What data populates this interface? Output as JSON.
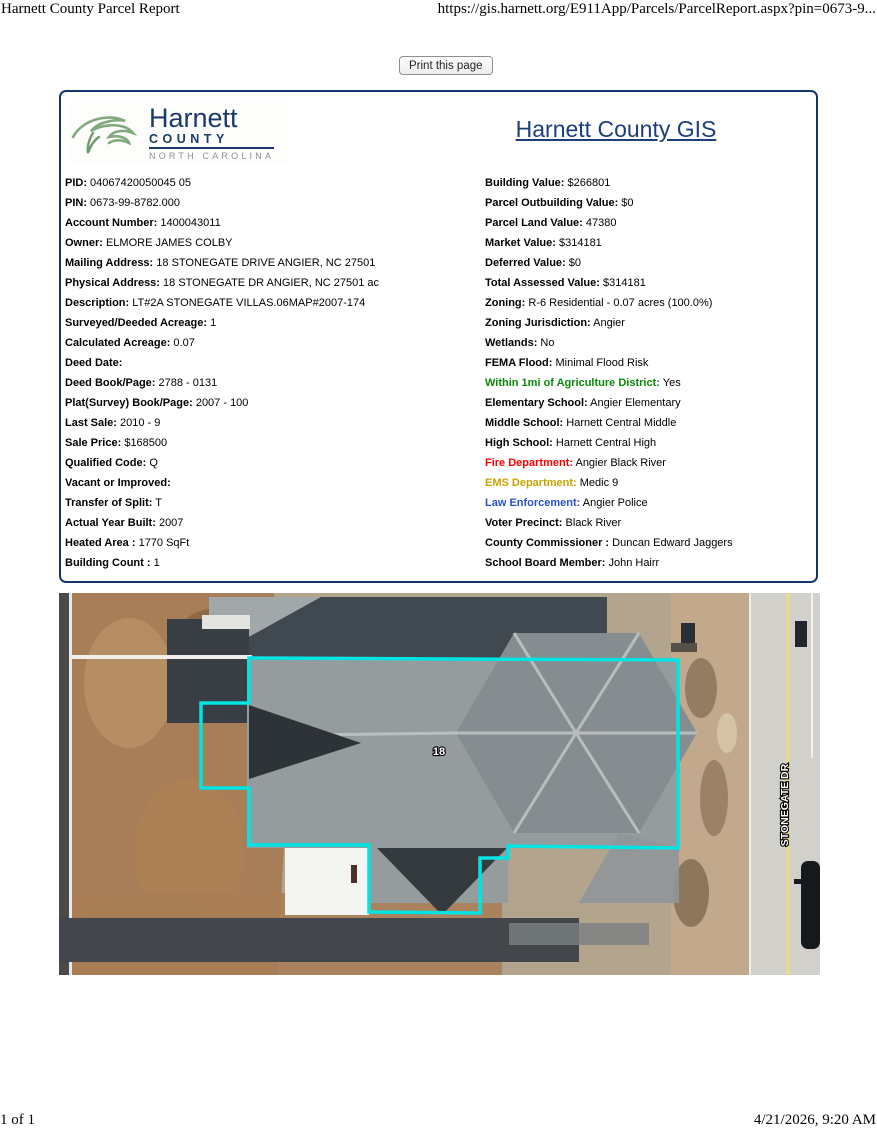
{
  "print_header": {
    "title": "Harnett County Parcel Report",
    "url": "https://gis.harnett.org/E911App/Parcels/ParcelReport.aspx?pin=0673-9..."
  },
  "toolbar": {
    "print_button_label": "Print this page"
  },
  "report": {
    "logo": {
      "name": "Harnett",
      "county_word": "COUNTY",
      "state_word": "NORTH CAROLINA"
    },
    "title": "Harnett County GIS",
    "left_fields": [
      {
        "label": "PID:",
        "value": "04067420050045 05"
      },
      {
        "label": "PIN:",
        "value": "0673-99-8782.000"
      },
      {
        "label": "Account Number:",
        "value": "1400043011"
      },
      {
        "label": "Owner:",
        "value": "ELMORE JAMES COLBY"
      },
      {
        "label": "Mailing Address:",
        "value": "18 STONEGATE DRIVE ANGIER, NC 27501"
      },
      {
        "label": "Physical Address:",
        "value": "18 STONEGATE DR ANGIER, NC 27501 ac"
      },
      {
        "label": "Description:",
        "value": "LT#2A STONEGATE VILLAS.06MAP#2007-174"
      },
      {
        "label": "Surveyed/Deeded Acreage:",
        "value": "1"
      },
      {
        "label": "Calculated Acreage:",
        "value": "0.07"
      },
      {
        "label": "Deed Date:",
        "value": ""
      },
      {
        "label": "Deed Book/Page:",
        "value": "2788 - 0131"
      },
      {
        "label": "Plat(Survey) Book/Page:",
        "value": "2007 - 100"
      },
      {
        "label": "Last Sale:",
        "value": "2010 - 9"
      },
      {
        "label": "Sale Price:",
        "value": "$168500"
      },
      {
        "label": "Qualified Code:",
        "value": "Q"
      },
      {
        "label": "Vacant or Improved:",
        "value": ""
      },
      {
        "label": "Transfer of Split:",
        "value": "T"
      },
      {
        "label": "Actual Year Built:",
        "value": "2007"
      },
      {
        "label": "Heated Area :",
        "value": "1770 SqFt"
      },
      {
        "label": "Building Count :",
        "value": "1"
      }
    ],
    "right_fields": [
      {
        "label": "Building Value:",
        "value": "$266801"
      },
      {
        "label": "Parcel Outbuilding Value:",
        "value": "$0"
      },
      {
        "label": "Parcel Land Value:",
        "value": "47380"
      },
      {
        "label": "Market Value:",
        "value": "$314181"
      },
      {
        "label": "Deferred Value:",
        "value": "$0"
      },
      {
        "label": "Total Assessed Value:",
        "value": "$314181"
      },
      {
        "label": "Zoning:",
        "value": "R-6 Residential - 0.07 acres (100.0%)"
      },
      {
        "label": "Zoning Jurisdiction:",
        "value": "Angier"
      },
      {
        "label": "Wetlands:",
        "value": "No"
      },
      {
        "label": "FEMA Flood:",
        "value": "Minimal Flood Risk"
      },
      {
        "label": "Within 1mi of Agriculture District:",
        "value": "Yes",
        "label_color": "#0a8a0a"
      },
      {
        "label": "Elementary School:",
        "value": "Angier Elementary"
      },
      {
        "label": "Middle School:",
        "value": "Harnett Central Middle"
      },
      {
        "label": "High School:",
        "value": "Harnett Central High"
      },
      {
        "label": "Fire Department:",
        "value": "Angier Black River",
        "label_color": "#ff0000"
      },
      {
        "label": "EMS Department:",
        "value": "Medic 9",
        "label_color": "#c9a400"
      },
      {
        "label": "Law Enforcement:",
        "value": "Angier Police",
        "label_color": "#2850c8"
      },
      {
        "label": "Voter Precinct:",
        "value": "Black River"
      },
      {
        "label": "County Commissioner :",
        "value": "Duncan Edward Jaggers"
      },
      {
        "label": "School Board Member:",
        "value": "John Hairr"
      }
    ]
  },
  "map": {
    "parcel_label": "18",
    "street_label": "STONEGATE DR",
    "parcel_outline_color": "#00e4e4"
  },
  "footer": {
    "page_indicator": "1 of 1",
    "datetime": "4/21/2026, 9:20 AM"
  },
  "colors": {
    "report_border_navy": "#15356b",
    "gis_link_blue": "#1d3e7d",
    "logo_navy": "#1b3a6b",
    "logo_green": "#82a97e",
    "agriculture_label_green": "#0a8a0a",
    "fire_label_red": "#ff0000",
    "ems_label_gold": "#c9a400",
    "law_label_blue": "#2850c8"
  }
}
